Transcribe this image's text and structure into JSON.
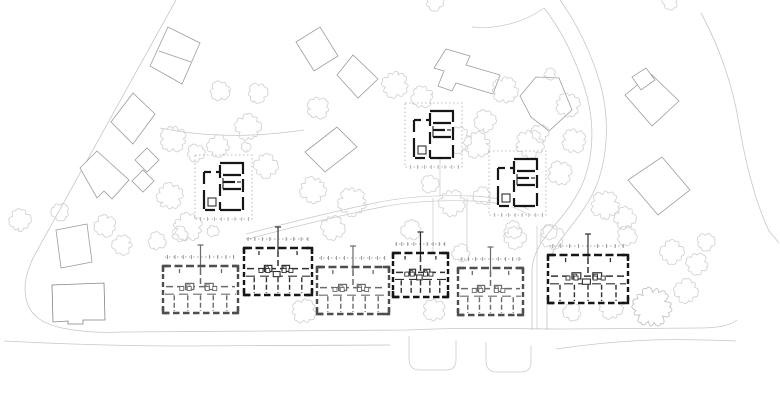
{
  "canvas": {
    "w": 780,
    "h": 401
  },
  "colors": {
    "bg": "#ffffff",
    "context_stroke": "#9d9d9d",
    "context_dark": "#848484",
    "tree": "#d3d3d3",
    "tree_dark": "#c2c2c2",
    "road": "#c7c7c7",
    "faint": "#d2d2d2",
    "wall_black": "#161616",
    "wall_gray": "#4e4e4e",
    "thin_black": "#303030",
    "thin_gray": "#6b6b6b",
    "dotted": "#8f8f8f",
    "plot_dotted": "#a8a8a8"
  },
  "roads": [
    {
      "d": "M176,0 L33,258 C27,272 23,284 26,298 C29,314 40,323 62,328 C82,332 100,333 125,332 L408,330 C470,327 520,329 562,329 L700,328 C718,328 731,325 737,320",
      "w": 0.8
    },
    {
      "d": "M4,341 C60,344 120,346 185,346 L390,345",
      "w": 0.8
    },
    {
      "d": "M701,13 C719,46 733,86 739,124 C745,160 754,199 769,231 L779,243",
      "w": 0.8
    },
    {
      "d": "M472,27 C500,30 528,20 544,8",
      "w": 0.7
    },
    {
      "d": "M544,8 C560,28 574,56 584,86 C594,116 595,150 584,180 C574,206 556,222 544,239 C536,250 532,260 532,273 L532,330",
      "w": 0.8
    },
    {
      "d": "M560,0 C576,22 591,52 600,83 C609,114 609,152 597,184 C587,210 569,227 557,245 C550,256 547,265 547,277 L547,330",
      "w": 0.8
    },
    {
      "d": "M246,234 C280,225 330,212 380,202 C410,196 442,195 472,196 C497,197 516,202 529,210",
      "w": 0.7
    },
    {
      "d": "M248,239 C282,230 332,217 382,207 C412,201 444,200 473,201 C497,202 515,206 527,214",
      "w": 0.7
    },
    {
      "d": "M160,128 C215,139 262,136 304,130",
      "w": 0.7
    },
    {
      "d": "M440,152 L440,196",
      "w": 0.7
    },
    {
      "d": "M433,198 L433,252",
      "w": 0.7
    },
    {
      "d": "M467,198 L467,252",
      "w": 0.7
    },
    {
      "d": "M537,226 L537,329",
      "w": 0.7
    },
    {
      "d": "M409,336 L409,359 Q409,370 420,370 L446,370 Q456,370 456,360 L456,340",
      "w": 0.7
    },
    {
      "d": "M486,342 L486,361 Q486,372 497,372 L521,372 Q531,372 531,362 L531,346",
      "w": 0.7
    },
    {
      "d": "M556,349 C590,344 622,341 652,340 C682,339 712,340 736,341",
      "w": 0.7
    }
  ],
  "context_buildings": [
    {
      "points": [
        [
          150,
          66
        ],
        [
          168,
          27
        ],
        [
          200,
          43
        ],
        [
          182,
          84
        ]
      ],
      "lines": [
        [
          159,
          51
        ],
        [
          191,
          62
        ]
      ]
    },
    {
      "points": [
        [
          296,
          42
        ],
        [
          320,
          27
        ],
        [
          338,
          56
        ],
        [
          314,
          71
        ]
      ]
    },
    {
      "points": [
        [
          337,
          75
        ],
        [
          353,
          55
        ],
        [
          378,
          79
        ],
        [
          358,
          98
        ]
      ]
    },
    {
      "points": [
        [
          434,
          68
        ],
        [
          446,
          49
        ],
        [
          470,
          56
        ],
        [
          466,
          65
        ],
        [
          500,
          75
        ],
        [
          493,
          94
        ],
        [
          456,
          83
        ],
        [
          452,
          91
        ],
        [
          438,
          86
        ],
        [
          444,
          71
        ]
      ]
    },
    {
      "points": [
        [
          520,
          96
        ],
        [
          536,
          77
        ],
        [
          559,
          78
        ],
        [
          572,
          110
        ],
        [
          549,
          131
        ],
        [
          531,
          117
        ]
      ]
    },
    {
      "points": [
        [
          625,
          95
        ],
        [
          651,
          74
        ],
        [
          679,
          101
        ],
        [
          652,
          126
        ]
      ]
    },
    {
      "points": [
        [
          632,
          77
        ],
        [
          646,
          68
        ],
        [
          655,
          80
        ],
        [
          641,
          90
        ]
      ]
    },
    {
      "points": [
        [
          628,
          180
        ],
        [
          662,
          157
        ],
        [
          690,
          190
        ],
        [
          658,
          215
        ]
      ]
    },
    {
      "points": [
        [
          111,
          122
        ],
        [
          133,
          93
        ],
        [
          155,
          114
        ],
        [
          133,
          144
        ]
      ]
    },
    {
      "points": [
        [
          80,
          168
        ],
        [
          97,
          151
        ],
        [
          129,
          180
        ],
        [
          112,
          199
        ],
        [
          104,
          191
        ],
        [
          97,
          198
        ]
      ]
    },
    {
      "points": [
        [
          135,
          160
        ],
        [
          147,
          148
        ],
        [
          159,
          160
        ],
        [
          147,
          172
        ]
      ]
    },
    {
      "points": [
        [
          132,
          181
        ],
        [
          143,
          170
        ],
        [
          154,
          181
        ],
        [
          143,
          192
        ]
      ]
    },
    {
      "points": [
        [
          56,
          230
        ],
        [
          87,
          224
        ],
        [
          92,
          262
        ],
        [
          61,
          268
        ]
      ]
    },
    {
      "points": [
        [
          52,
          285
        ],
        [
          104,
          283
        ],
        [
          105,
          320
        ],
        [
          83,
          320
        ],
        [
          83,
          324
        ],
        [
          68,
          324
        ],
        [
          68,
          321
        ],
        [
          53,
          322
        ]
      ],
      "dark": true
    },
    {
      "points": [
        [
          305,
          152
        ],
        [
          337,
          127
        ],
        [
          357,
          147
        ],
        [
          325,
          172
        ]
      ]
    }
  ],
  "trees": [
    [
      220,
      91,
      10
    ],
    [
      248,
      127,
      13
    ],
    [
      258,
      93,
      10
    ],
    [
      318,
      108,
      11
    ],
    [
      435,
      2,
      9
    ],
    [
      395,
      85,
      13
    ],
    [
      422,
      97,
      11
    ],
    [
      505,
      90,
      13
    ],
    [
      485,
      121,
      11
    ],
    [
      550,
      74,
      6
    ],
    [
      568,
      105,
      12
    ],
    [
      173,
      139,
      13
    ],
    [
      196,
      153,
      9
    ],
    [
      218,
      146,
      11
    ],
    [
      246,
      147,
      5
    ],
    [
      170,
      196,
      13
    ],
    [
      188,
      227,
      14
    ],
    [
      266,
      166,
      12
    ],
    [
      313,
      190,
      13
    ],
    [
      352,
      202,
      14
    ],
    [
      333,
      228,
      12
    ],
    [
      430,
      184,
      9
    ],
    [
      458,
      140,
      13
    ],
    [
      452,
      203,
      13
    ],
    [
      411,
      230,
      10
    ],
    [
      477,
      145,
      13
    ],
    [
      482,
      196,
      9
    ],
    [
      513,
      230,
      9
    ],
    [
      530,
      144,
      14
    ],
    [
      574,
      141,
      12
    ],
    [
      560,
      173,
      12
    ],
    [
      552,
      237,
      12
    ],
    [
      540,
      133,
      9
    ],
    [
      605,
      205,
      14
    ],
    [
      625,
      218,
      11
    ],
    [
      670,
      2,
      8
    ],
    [
      627,
      236,
      10
    ],
    [
      672,
      252,
      12
    ],
    [
      697,
      264,
      11
    ],
    [
      686,
      291,
      12
    ],
    [
      706,
      242,
      9
    ],
    [
      652,
      307,
      19,
      1
    ],
    [
      611,
      307,
      12
    ],
    [
      572,
      312,
      9
    ],
    [
      434,
      310,
      11
    ],
    [
      304,
      311,
      12
    ],
    [
      157,
      241,
      9
    ],
    [
      180,
      234,
      8
    ],
    [
      213,
      231,
      6
    ],
    [
      105,
      226,
      11
    ],
    [
      122,
      245,
      10
    ],
    [
      60,
      212,
      9
    ],
    [
      20,
      220,
      11
    ],
    [
      461,
      253,
      9
    ],
    [
      515,
      238,
      11
    ],
    [
      549,
      232,
      8
    ]
  ],
  "small_house_plan": {
    "w": 41,
    "h": 49,
    "thick": [
      [
        17,
        1,
        41,
        1
      ],
      [
        40,
        1,
        40,
        12
      ],
      [
        40,
        17,
        40,
        30
      ],
      [
        40,
        35,
        40,
        48
      ],
      [
        17,
        48,
        38,
        48
      ],
      [
        2,
        48,
        12,
        48
      ],
      [
        1,
        10,
        1,
        22
      ],
      [
        1,
        28,
        1,
        47
      ],
      [
        1,
        10,
        8,
        10
      ],
      [
        13,
        10,
        17,
        10
      ],
      [
        17,
        3,
        17,
        16
      ],
      [
        17,
        22,
        17,
        34
      ],
      [
        17,
        40,
        17,
        48
      ],
      [
        20,
        13,
        38,
        13
      ],
      [
        20,
        20,
        32,
        20
      ],
      [
        20,
        27,
        38,
        27
      ]
    ],
    "thin": [
      [
        20,
        16,
        20,
        27
      ],
      [
        5,
        40,
        13,
        40
      ],
      [
        34,
        20,
        38,
        20
      ]
    ],
    "boxes": [
      [
        5,
        36,
        8,
        8
      ]
    ],
    "plot_pad": [
      8,
      7,
      8,
      8
    ]
  },
  "small_houses": [
    {
      "x": 203,
      "y": 162
    },
    {
      "x": 413,
      "y": 110
    },
    {
      "x": 497,
      "y": 158
    }
  ],
  "row_plan": {
    "dotted_offset": 9,
    "stack_top": 21,
    "tick_fr": [
      0.06,
      0.16,
      0.27,
      0.38,
      0.5,
      0.62,
      0.73,
      0.84,
      0.94
    ],
    "mid_fr": 0.44,
    "low_fr": 0.6,
    "bottom_walls_fr": [
      0.15,
      0.33,
      0.5,
      0.67,
      0.85
    ],
    "top_stubs_fr": [
      0.22,
      0.78
    ],
    "boxes_fr": [
      [
        0.3,
        0.37,
        0.11,
        0.13
      ],
      [
        0.56,
        0.37,
        0.11,
        0.13
      ]
    ],
    "mini_fr": [
      [
        0.315,
        0.4,
        0.045,
        0.07
      ],
      [
        0.575,
        0.4,
        0.045,
        0.07
      ]
    ],
    "squares_fr": [
      [
        0.25,
        0.48
      ],
      [
        0.35,
        0.48
      ],
      [
        0.59,
        0.48
      ],
      [
        0.69,
        0.48
      ]
    ],
    "extra_box_B": [
      0.43,
      0.5,
      0.1,
      0.11
    ]
  },
  "row_houses": [
    {
      "x": 163,
      "y": 266,
      "w": 75,
      "h": 47,
      "type": "A"
    },
    {
      "x": 244,
      "y": 248,
      "w": 68,
      "h": 47,
      "type": "B"
    },
    {
      "x": 317,
      "y": 267,
      "w": 72,
      "h": 47,
      "type": "A"
    },
    {
      "x": 393,
      "y": 253,
      "w": 55,
      "h": 44,
      "type": "B"
    },
    {
      "x": 458,
      "y": 268,
      "w": 65,
      "h": 47,
      "type": "A"
    },
    {
      "x": 548,
      "y": 255,
      "w": 80,
      "h": 48,
      "type": "B"
    }
  ]
}
